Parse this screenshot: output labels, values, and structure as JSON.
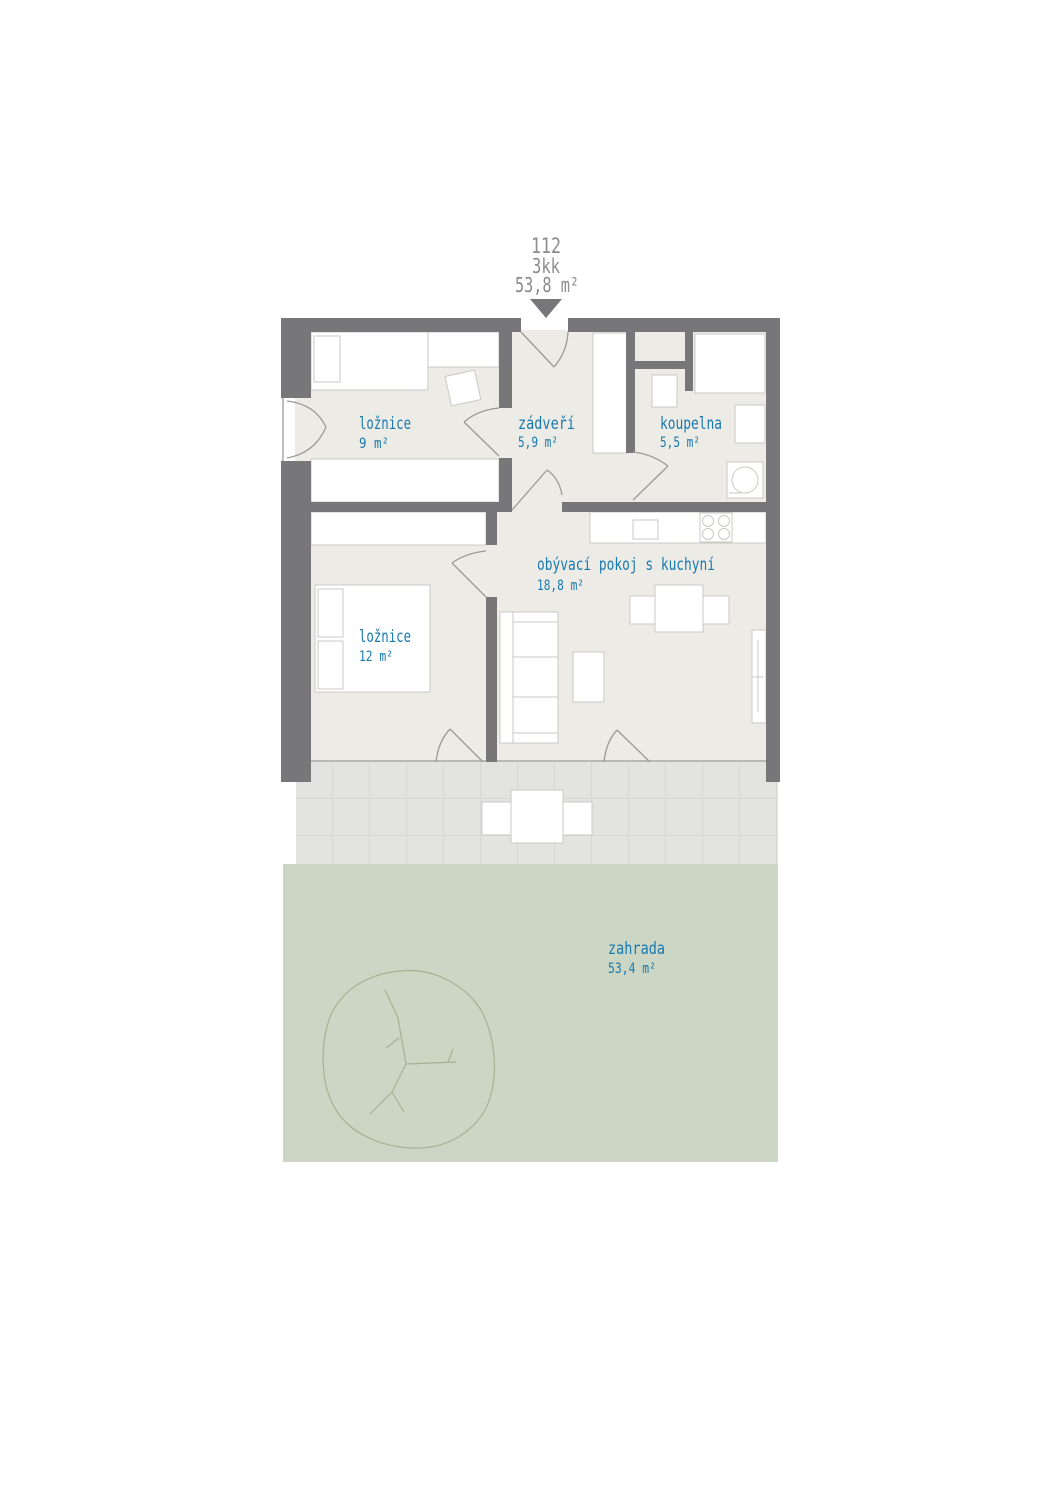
{
  "header": {
    "unit_number": "112",
    "layout_type": "3kk",
    "total_area": "53,8 m²"
  },
  "rooms": [
    {
      "id": "loznice-1",
      "name": "ložnice",
      "area": "9 m²"
    },
    {
      "id": "zadveri",
      "name": "zádveří",
      "area": "5,9 m²"
    },
    {
      "id": "koupelna",
      "name": "koupelna",
      "area": "5,5 m²"
    },
    {
      "id": "obyvaci-pokoj",
      "name": "obývací pokoj s kuchyní",
      "area": "18,8 m²"
    },
    {
      "id": "loznice-2",
      "name": "ložnice",
      "area": "12 m²"
    },
    {
      "id": "zahrada",
      "name": "zahrada",
      "area": "53,4 m²"
    }
  ],
  "colors": {
    "wall": "#77777a",
    "floor": "#edebe6",
    "furniture_stroke": "#c9c9c4",
    "door_line": "#9a9a96",
    "terrace": "#e3e4e2",
    "terrace_grid": "#d7d8d6",
    "garden": "#ccd6c4",
    "tree": "#a4b294",
    "label": "#1879ae",
    "header_text": "#8c8c8e"
  }
}
